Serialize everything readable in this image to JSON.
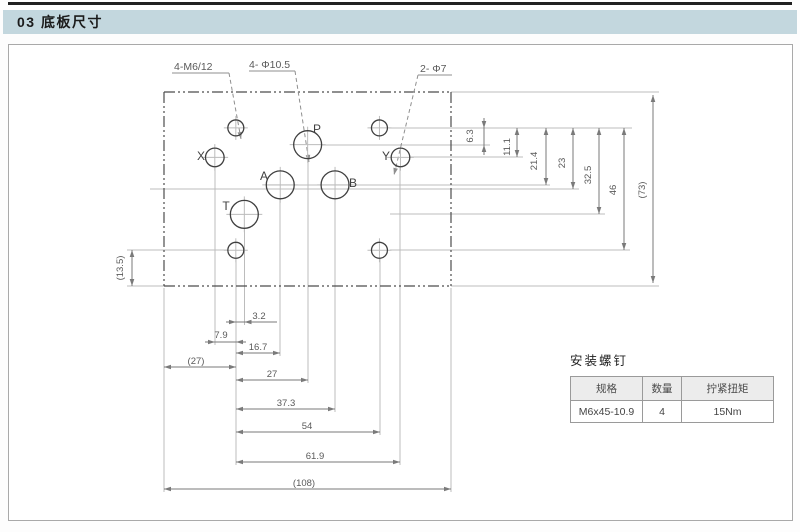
{
  "page": {
    "section_title": "03 底板尺寸"
  },
  "drawing": {
    "callouts": [
      "4-M6/12",
      "4- Φ10.5",
      "2- Φ7"
    ],
    "plate": {
      "width_mm": 108,
      "height_mm": 73
    },
    "holes": [
      {
        "id": "bolt-tl",
        "x": 27,
        "y": 13.5,
        "d": 6
      },
      {
        "id": "bolt-tr",
        "x": 81,
        "y": 13.5,
        "d": 6
      },
      {
        "id": "bolt-bl",
        "x": 27,
        "y": 59.5,
        "d": 6
      },
      {
        "id": "bolt-br",
        "x": 81,
        "y": 59.5,
        "d": 6
      },
      {
        "id": "P",
        "label": "P",
        "x": 54,
        "y": 19.8,
        "d": 10.5
      },
      {
        "id": "A",
        "label": "A",
        "x": 43.7,
        "y": 34.9,
        "d": 10.5
      },
      {
        "id": "B",
        "label": "B",
        "x": 64.3,
        "y": 34.9,
        "d": 10.5
      },
      {
        "id": "T",
        "label": "T",
        "x": 30.2,
        "y": 46,
        "d": 10.5
      },
      {
        "id": "X",
        "label": "X",
        "x": 19.1,
        "y": 24.6,
        "d": 7
      },
      {
        "id": "Y",
        "label": "Y",
        "x": 88.9,
        "y": 24.6,
        "d": 7
      }
    ],
    "dims_right": [
      "6.3",
      "11.1",
      "21.4",
      "23",
      "32.5",
      "46",
      "(73)"
    ],
    "dims_left": [
      "(13.5)"
    ],
    "dims_bottom": [
      "3.2",
      "7.9",
      "16.7",
      "(27)",
      "27",
      "37.3",
      "54",
      "61.9",
      "(108)"
    ]
  },
  "screws_table": {
    "title": "安装螺钉",
    "headers": [
      "规格",
      "数量",
      "拧紧扭矩"
    ],
    "rows": [
      [
        "M6x45-10.9",
        "4",
        "15Nm"
      ]
    ]
  },
  "colors": {
    "header_bar": "#c3d7de",
    "table_header_bg": "#ececec"
  }
}
